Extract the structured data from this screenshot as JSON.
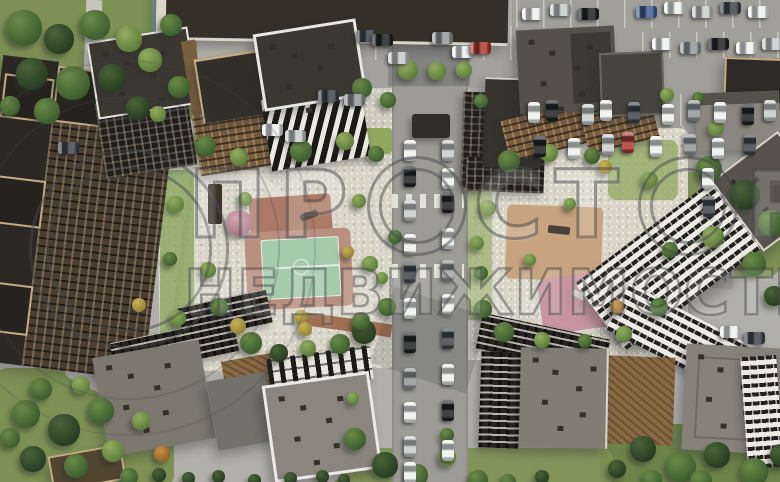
{
  "scene": {
    "type": "aerial-3d-render",
    "subject": "Top-down aerial render of a residential complex with courtyards, playgrounds, roads and parking"
  },
  "watermark": {
    "line1": "ПРОСТОР",
    "line1_seg1": "ПР",
    "line1_seg2": "СТ",
    "line1_seg3": "Р",
    "line2": "НЕДВИЖИМОСТЬ",
    "color": "rgba(72,74,76,0.5)"
  },
  "palette": {
    "pavement": "#b0afa9",
    "gravel": "#d9d6c8",
    "road": "#9c9b95",
    "park_green": "#7d9154",
    "court_green": "#a6cbab",
    "playground_terracotta": "#ab7a66",
    "playground_tan": "#c8a37f",
    "playground_pink": "#c795a2",
    "roof_dark": "#2b2823",
    "roof_gray": "#85817a",
    "beige_trim": "#c3ac85",
    "bronze": "#8a6a45",
    "facade_white": "#eceae3"
  },
  "tree_colors": {
    "d": [
      "#4a6338",
      "#263c22"
    ],
    "m": [
      "#6b8a48",
      "#3c5c2e"
    ],
    "l": [
      "#93ad5e",
      "#5d7c3c"
    ],
    "y": [
      "#c9b352",
      "#95803a"
    ],
    "o": [
      "#c89043",
      "#8f6226"
    ],
    "p": [
      "#d2a8b4",
      "#a1707f"
    ]
  },
  "car_colors": {
    "w": "#eef0ec",
    "k": "#17191b",
    "s": "#c6cac8",
    "g": "#8f9494",
    "d": "#3a3f44",
    "b": "#3c5a8c",
    "r": "#ab342a"
  },
  "trees": [
    [
      6,
      10,
      36,
      "m"
    ],
    [
      44,
      24,
      30,
      "d"
    ],
    [
      80,
      10,
      30,
      "m"
    ],
    [
      116,
      26,
      26,
      "l"
    ],
    [
      16,
      58,
      32,
      "d"
    ],
    [
      56,
      66,
      34,
      "m"
    ],
    [
      98,
      64,
      28,
      "d"
    ],
    [
      138,
      48,
      24,
      "l"
    ],
    [
      160,
      14,
      22,
      "m"
    ],
    [
      168,
      76,
      22,
      "m"
    ],
    [
      126,
      96,
      24,
      "d"
    ],
    [
      34,
      98,
      26,
      "m"
    ],
    [
      0,
      96,
      20,
      "m"
    ],
    [
      150,
      106,
      16,
      "l"
    ],
    [
      196,
      136,
      20,
      "m"
    ],
    [
      230,
      148,
      18,
      "l"
    ],
    [
      290,
      140,
      22,
      "m"
    ],
    [
      336,
      132,
      18,
      "l"
    ],
    [
      368,
      146,
      16,
      "m"
    ],
    [
      168,
      196,
      16,
      "l"
    ],
    [
      163,
      252,
      14,
      "m"
    ],
    [
      170,
      310,
      16,
      "l"
    ],
    [
      238,
      192,
      14,
      "l"
    ],
    [
      226,
      210,
      26,
      "p"
    ],
    [
      200,
      262,
      16,
      "l"
    ],
    [
      210,
      298,
      18,
      "m"
    ],
    [
      240,
      332,
      22,
      "m"
    ],
    [
      270,
      344,
      18,
      "d"
    ],
    [
      300,
      340,
      16,
      "l"
    ],
    [
      330,
      334,
      20,
      "m"
    ],
    [
      294,
      310,
      14,
      "y"
    ],
    [
      352,
      320,
      24,
      "d"
    ],
    [
      378,
      298,
      18,
      "m"
    ],
    [
      362,
      256,
      16,
      "l"
    ],
    [
      388,
      230,
      14,
      "m"
    ],
    [
      352,
      194,
      14,
      "l"
    ],
    [
      342,
      246,
      12,
      "y"
    ],
    [
      230,
      318,
      16,
      "y"
    ],
    [
      298,
      322,
      14,
      "y"
    ],
    [
      132,
      298,
      14,
      "y"
    ],
    [
      352,
      312,
      18,
      "m"
    ],
    [
      398,
      60,
      20,
      "l"
    ],
    [
      428,
      62,
      18,
      "l"
    ],
    [
      456,
      62,
      16,
      "l"
    ],
    [
      352,
      78,
      20,
      "m"
    ],
    [
      380,
      92,
      16,
      "m"
    ],
    [
      474,
      94,
      14,
      "m"
    ],
    [
      376,
      272,
      12,
      "l"
    ],
    [
      470,
      236,
      14,
      "l"
    ],
    [
      474,
      266,
      14,
      "m"
    ],
    [
      498,
      150,
      22,
      "m"
    ],
    [
      540,
      144,
      18,
      "l"
    ],
    [
      584,
      148,
      16,
      "m"
    ],
    [
      480,
      200,
      16,
      "l"
    ],
    [
      474,
      300,
      18,
      "m"
    ],
    [
      494,
      322,
      20,
      "m"
    ],
    [
      534,
      332,
      16,
      "l"
    ],
    [
      578,
      334,
      14,
      "m"
    ],
    [
      616,
      326,
      16,
      "l"
    ],
    [
      650,
      298,
      18,
      "m"
    ],
    [
      598,
      160,
      14,
      "y"
    ],
    [
      642,
      172,
      16,
      "l"
    ],
    [
      662,
      242,
      16,
      "m"
    ],
    [
      524,
      254,
      12,
      "l"
    ],
    [
      564,
      198,
      12,
      "l"
    ],
    [
      610,
      300,
      14,
      "o"
    ],
    [
      696,
      156,
      26,
      "m"
    ],
    [
      730,
      180,
      30,
      "d"
    ],
    [
      758,
      210,
      26,
      "m"
    ],
    [
      702,
      226,
      22,
      "l"
    ],
    [
      742,
      252,
      24,
      "m"
    ],
    [
      764,
      286,
      20,
      "d"
    ],
    [
      708,
      120,
      16,
      "l"
    ],
    [
      660,
      88,
      14,
      "l"
    ],
    [
      692,
      92,
      12,
      "m"
    ],
    [
      630,
      436,
      26,
      "d"
    ],
    [
      666,
      452,
      30,
      "m"
    ],
    [
      704,
      442,
      26,
      "d"
    ],
    [
      740,
      458,
      28,
      "m"
    ],
    [
      770,
      444,
      22,
      "d"
    ],
    [
      690,
      470,
      22,
      "m"
    ],
    [
      642,
      470,
      20,
      "m"
    ],
    [
      608,
      460,
      18,
      "d"
    ],
    [
      344,
      428,
      22,
      "m"
    ],
    [
      372,
      452,
      26,
      "d"
    ],
    [
      406,
      464,
      22,
      "m"
    ],
    [
      438,
      448,
      18,
      "l"
    ],
    [
      468,
      470,
      20,
      "m"
    ],
    [
      347,
      392,
      12,
      "l"
    ],
    [
      500,
      474,
      16,
      "m"
    ],
    [
      535,
      470,
      14,
      "d"
    ],
    [
      440,
      428,
      14,
      "m"
    ],
    [
      12,
      400,
      28,
      "m"
    ],
    [
      48,
      414,
      32,
      "d"
    ],
    [
      88,
      398,
      26,
      "m"
    ],
    [
      20,
      446,
      26,
      "d"
    ],
    [
      64,
      454,
      24,
      "m"
    ],
    [
      102,
      440,
      22,
      "l"
    ],
    [
      120,
      468,
      18,
      "m"
    ],
    [
      132,
      412,
      18,
      "l"
    ],
    [
      154,
      446,
      16,
      "o"
    ],
    [
      30,
      378,
      22,
      "m"
    ],
    [
      72,
      376,
      18,
      "l"
    ],
    [
      0,
      428,
      20,
      "m"
    ],
    [
      152,
      468,
      14,
      "d"
    ],
    [
      182,
      472,
      13,
      "d"
    ],
    [
      212,
      470,
      13,
      "d"
    ],
    [
      248,
      474,
      13,
      "d"
    ],
    [
      284,
      472,
      13,
      "d"
    ],
    [
      316,
      470,
      13,
      "d"
    ],
    [
      338,
      474,
      12,
      "d"
    ]
  ],
  "cars": [
    [
      404,
      140,
      "v",
      "w"
    ],
    [
      404,
      166,
      "v",
      "k"
    ],
    [
      404,
      200,
      "v",
      "s"
    ],
    [
      404,
      234,
      "v",
      "w"
    ],
    [
      404,
      262,
      "v",
      "d"
    ],
    [
      404,
      298,
      "v",
      "w"
    ],
    [
      404,
      332,
      "v",
      "k"
    ],
    [
      404,
      368,
      "v",
      "g"
    ],
    [
      404,
      402,
      "v",
      "w"
    ],
    [
      404,
      436,
      "v",
      "s"
    ],
    [
      404,
      462,
      "v",
      "w"
    ],
    [
      442,
      140,
      "v",
      "s"
    ],
    [
      442,
      168,
      "v",
      "w"
    ],
    [
      442,
      192,
      "v",
      "k"
    ],
    [
      442,
      228,
      "v",
      "w"
    ],
    [
      442,
      260,
      "v",
      "g"
    ],
    [
      442,
      294,
      "v",
      "w"
    ],
    [
      442,
      328,
      "v",
      "d"
    ],
    [
      442,
      364,
      "v",
      "w"
    ],
    [
      442,
      400,
      "v",
      "k"
    ],
    [
      442,
      440,
      "v",
      "w"
    ],
    [
      522,
      8,
      "h",
      "w"
    ],
    [
      550,
      4,
      "h",
      "s"
    ],
    [
      578,
      8,
      "h",
      "k"
    ],
    [
      636,
      6,
      "h",
      "b"
    ],
    [
      664,
      2,
      "h",
      "w"
    ],
    [
      692,
      6,
      "h",
      "s"
    ],
    [
      720,
      2,
      "h",
      "d"
    ],
    [
      748,
      6,
      "h",
      "w"
    ],
    [
      652,
      38,
      "h",
      "w"
    ],
    [
      680,
      42,
      "h",
      "g"
    ],
    [
      708,
      38,
      "h",
      "k"
    ],
    [
      736,
      42,
      "h",
      "w"
    ],
    [
      762,
      38,
      "h",
      "s"
    ],
    [
      528,
      102,
      "v",
      "w"
    ],
    [
      546,
      100,
      "v",
      "k"
    ],
    [
      582,
      104,
      "v",
      "s"
    ],
    [
      600,
      100,
      "v",
      "w"
    ],
    [
      628,
      102,
      "v",
      "d"
    ],
    [
      662,
      104,
      "v",
      "w"
    ],
    [
      688,
      100,
      "v",
      "g"
    ],
    [
      714,
      102,
      "v",
      "w"
    ],
    [
      742,
      104,
      "v",
      "k"
    ],
    [
      764,
      100,
      "v",
      "s"
    ],
    [
      534,
      136,
      "v",
      "k"
    ],
    [
      568,
      138,
      "v",
      "w"
    ],
    [
      602,
      134,
      "v",
      "s"
    ],
    [
      622,
      132,
      "v",
      "r"
    ],
    [
      650,
      136,
      "v",
      "w"
    ],
    [
      684,
      134,
      "v",
      "g"
    ],
    [
      712,
      138,
      "v",
      "w"
    ],
    [
      744,
      134,
      "v",
      "d"
    ],
    [
      702,
      168,
      "v",
      "w"
    ],
    [
      703,
      196,
      "v",
      "d"
    ],
    [
      720,
      326,
      "h",
      "w"
    ],
    [
      744,
      332,
      "h",
      "d"
    ],
    [
      356,
      30,
      "h",
      "d"
    ],
    [
      372,
      34,
      "h",
      "k"
    ],
    [
      388,
      52,
      "h",
      "s"
    ],
    [
      432,
      32,
      "h",
      "g"
    ],
    [
      452,
      46,
      "h",
      "w"
    ],
    [
      470,
      42,
      "h",
      "r"
    ],
    [
      262,
      124,
      "h",
      "w"
    ],
    [
      285,
      130,
      "h",
      "s"
    ],
    [
      318,
      90,
      "h",
      "d"
    ],
    [
      344,
      94,
      "h",
      "g"
    ],
    [
      58,
      142,
      "h",
      "d"
    ]
  ]
}
